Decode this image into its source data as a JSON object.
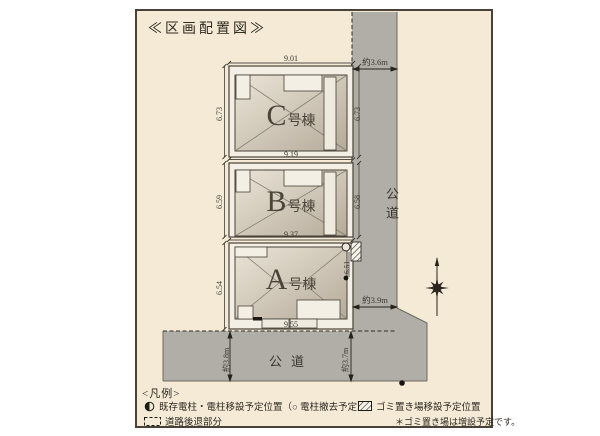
{
  "title": "≪区画配置図≫",
  "buildings": [
    {
      "letter": "C",
      "suffix": "号棟"
    },
    {
      "letter": "B",
      "suffix": "号棟"
    },
    {
      "letter": "A",
      "suffix": "号棟"
    }
  ],
  "dims": {
    "c_top": "9.01",
    "b_top": "9.19",
    "a_top": "9.37",
    "a_bottom": "9.55",
    "c_left": "6.73",
    "b_left": "6.59",
    "a_left": "6.54",
    "c_right": "6.73",
    "b_right": "6.58",
    "a_right": "6.51",
    "road_right_top": "約3.6m",
    "road_right_mid": "約3.9m",
    "road_bottom_left": "約3.8m",
    "road_bottom_right": "約3.7m"
  },
  "roads": {
    "right": "公道",
    "bottom": "公道"
  },
  "legend": {
    "header": "<凡例>",
    "pole": "既存電柱・電柱移設予定位置（○ 電柱撤去予定）",
    "trash": "ゴミ置き場移設予定位置",
    "setback": "道路後退部分",
    "note": "＊ゴミ置き場は増設予定です。"
  },
  "colors": {
    "background": "#f4ead6",
    "road": "#b1aea8",
    "plot": "#f3efe4",
    "outline": "#474138"
  }
}
